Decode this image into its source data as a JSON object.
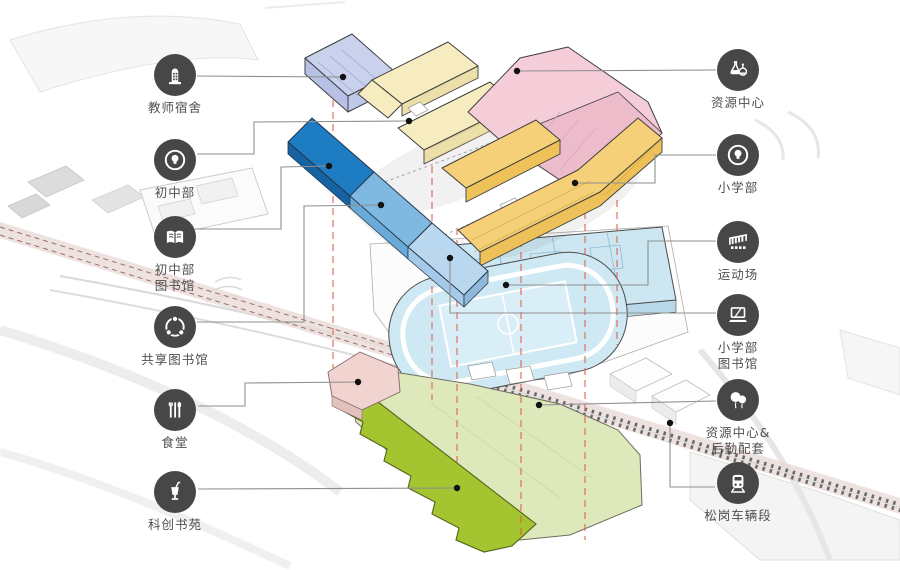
{
  "legend_left": [
    {
      "label": "教师宿舍",
      "icon": "dorm-building-icon"
    },
    {
      "label": "初中部",
      "icon": "idea-bulb-icon"
    },
    {
      "label": "初中部\n图书馆",
      "icon": "open-book-icon"
    },
    {
      "label": "共享图书馆",
      "icon": "share-network-icon"
    },
    {
      "label": "食堂",
      "icon": "cutlery-icon"
    },
    {
      "label": "科创书苑",
      "icon": "cup-straw-icon"
    }
  ],
  "legend_right": [
    {
      "label": "资源中心",
      "icon": "flasks-icon"
    },
    {
      "label": "小学部",
      "icon": "idea-bulb-icon"
    },
    {
      "label": "运动场",
      "icon": "grandstand-icon"
    },
    {
      "label": "小学部\n图书馆",
      "icon": "laptop-icon"
    },
    {
      "label": "资源中心&\n后勤配套",
      "icon": "balloons-icon"
    },
    {
      "label": "松岗车辆段",
      "icon": "train-icon"
    }
  ],
  "buildings": [
    {
      "name": "教师宿舍",
      "color": "#c9d1ec"
    },
    {
      "name": "初中部",
      "color": "#f6ecc0"
    },
    {
      "name": "资源中心",
      "color": "#f5cdd9"
    },
    {
      "name": "小学部",
      "color": "#f5d078"
    },
    {
      "name": "初中部图书馆",
      "color": "#1e7dc2"
    },
    {
      "name": "共享图书馆",
      "color": "#7fb9e2"
    },
    {
      "name": "小学部图书馆",
      "color": "#b9d8ef"
    },
    {
      "name": "运动场",
      "color": "#cfe9f4"
    },
    {
      "name": "食堂",
      "color": "#f1d3cf"
    },
    {
      "name": "资源中心&后勤配套",
      "color": "#dde9bb"
    },
    {
      "name": "科创书苑",
      "color": "#a4c430"
    },
    {
      "name": "松岗车辆段",
      "color": "#c9c9c9"
    }
  ],
  "colors": {
    "icon_circle": "#474747",
    "label_text": "#4f4f4f",
    "leader_line": "#8f8f8f",
    "projection_dash": "#e05a44"
  }
}
